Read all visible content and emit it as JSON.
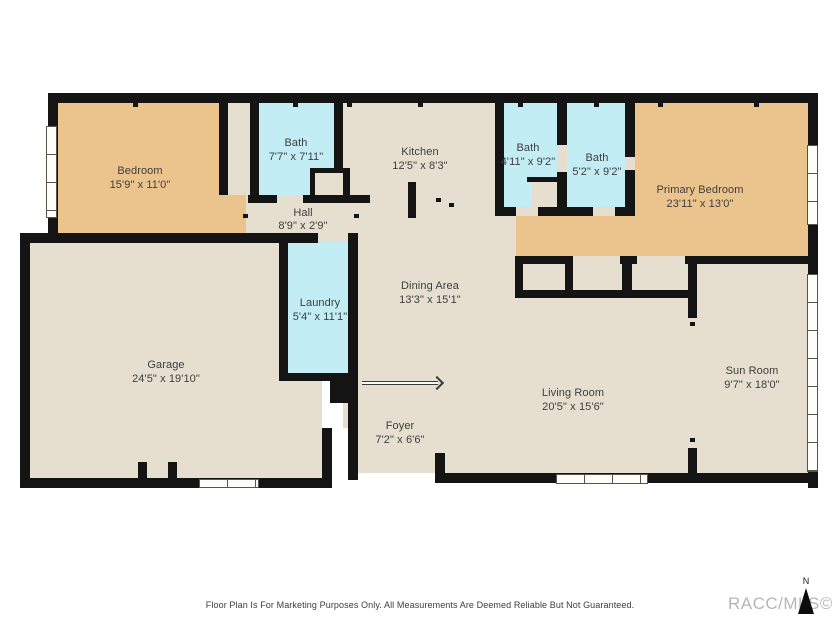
{
  "colors": {
    "floor_beige": "#e6dfd0",
    "bedroom_tan": "#ebc48d",
    "bath_blue": "#c2edf4",
    "wall_black": "#141414",
    "label_text": "#3e3e3e",
    "watermark_gray": "#b6b6b6"
  },
  "rooms": [
    {
      "name": "Bedroom",
      "dims": "15'9\" x 11'0\""
    },
    {
      "name": "Bath",
      "dims": "7'7\" x 7'11\""
    },
    {
      "name": "Kitchen",
      "dims": "12'5\" x 8'3\""
    },
    {
      "name": "Bath",
      "dims": "4'11\" x 9'2\""
    },
    {
      "name": "Bath",
      "dims": "5'2\" x 9'2\""
    },
    {
      "name": "Primary Bedroom",
      "dims": "23'11\" x 13'0\""
    },
    {
      "name": "Hall",
      "dims": "8'9\" x 2'9\""
    },
    {
      "name": "Laundry",
      "dims": "5'4\" x 11'1\""
    },
    {
      "name": "Dining Area",
      "dims": "13'3\" x 15'1\""
    },
    {
      "name": "Garage",
      "dims": "24'5\" x 19'10\""
    },
    {
      "name": "Living Room",
      "dims": "20'5\" x 15'6\""
    },
    {
      "name": "Foyer",
      "dims": "7'2\" x 6'6\""
    },
    {
      "name": "Sun Room",
      "dims": "9'7\" x 18'0\""
    }
  ],
  "footer": {
    "disclaimer": "Floor Plan Is For Marketing Purposes Only. All Measurements Are Deemed Reliable But Not Guaranteed.",
    "watermark": "RACC/MLS©",
    "compass_label": "N"
  }
}
